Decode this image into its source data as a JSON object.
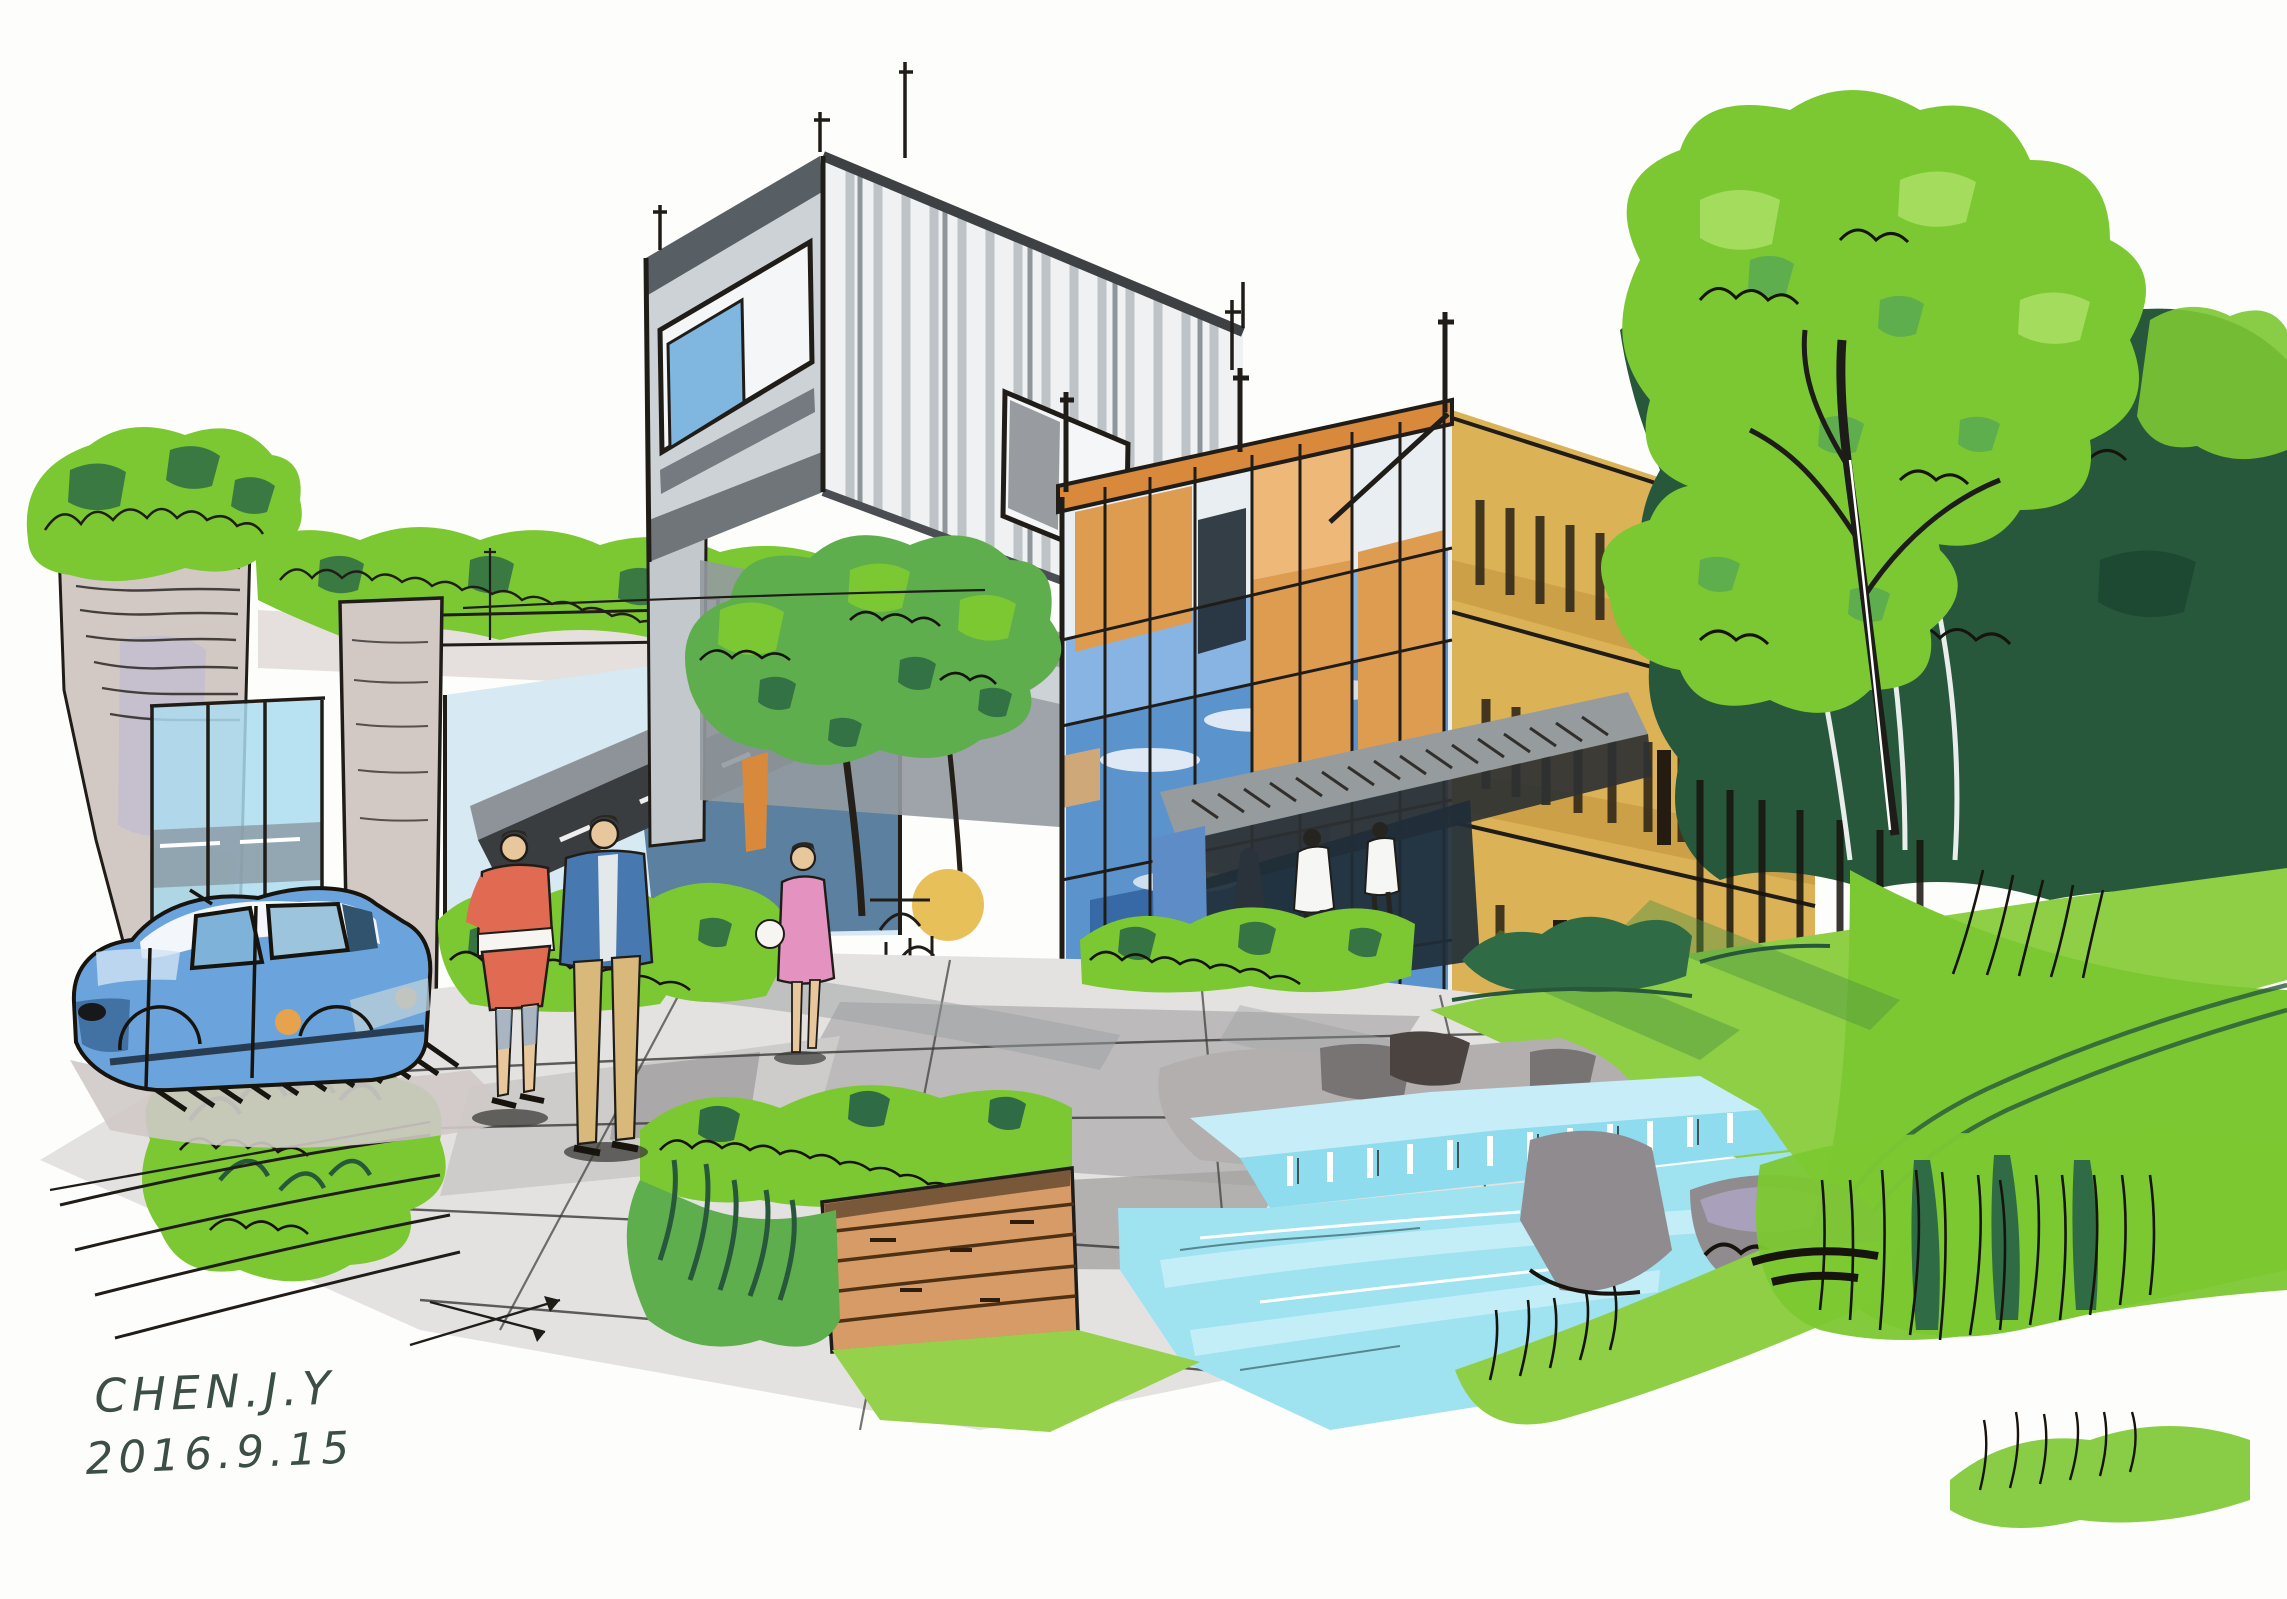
{
  "artwork": {
    "kind": "hand-drawn architectural marker sketch",
    "signature": {
      "line1": "CHEN.J.Y",
      "line2": "2016.9.15"
    }
  },
  "palette": {
    "paper": "#fdfdfb",
    "ink": "#201d19",
    "signature": "#3b4f44",
    "green-bright": "#7cc832",
    "green-light": "#a9de63",
    "green-mid": "#5fae4e",
    "green-dark": "#2f6b45",
    "green-deep": "#27583c",
    "lawn": "#8fcf45",
    "lawn-dark": "#4f9340",
    "taupe": "#d2c9c5",
    "taupe-dark": "#b7adaa",
    "lavender": "#b9b4d6",
    "box-light": "#cdd2d6",
    "box-face": "#eff1f2",
    "box-dark": "#585f64",
    "corrugation": "#b9bfc4",
    "corrugation-dark": "#8e959b",
    "support-gray": "#c3c8cc",
    "mass-gray": "#949aa0",
    "glass-pale": "#d7e9f2",
    "glass-fence": "#abdcee",
    "fence-band": "#8a98a4",
    "slab-light": "#8d9399",
    "slab-dark": "#3a3d40",
    "under-glass": "#456d92",
    "window-blue": "#7fb7e0",
    "curtain-blue": "#5b93cc",
    "curtain-light": "#8cb8e4",
    "curtain-deep": "#2e5f9e",
    "panel-dark": "#1f2a33",
    "orange": "#de9c50",
    "orange-light": "#eeb978",
    "orange-deep": "#d8893c",
    "tan": "#dcb257",
    "tan-band": "#c59a40",
    "slit": "#33291a",
    "awning": "#969b9e",
    "awning-shadow": "#2e3133",
    "entrance": "#1f2e38",
    "entrance-blue": "#5e8cc6",
    "pave": "#e4e2e1",
    "pave-mid": "#cecccb",
    "pave-dark": "#b5b3b3",
    "pave-deep": "#a6a4a4",
    "shadow-gray": "#9aa0a2",
    "stone": "#b3afae",
    "stone-dark": "#6e6a6a",
    "rock": "#8f8b8e",
    "rock-lavender": "#b3aace",
    "pool-pale": "#c6edf8",
    "pool-mid": "#8edcee",
    "pool-water": "#9fe2f0",
    "pool-streak": "#c9f0f9",
    "wood": "#d69b66",
    "wood-line": "#4e3015",
    "car-blue": "#6ba3dc",
    "car-deep": "#3b6a9a",
    "car-glass": "#7fb2d8",
    "car-glass2": "#9cc4dc",
    "amber": "#e6a24c",
    "skin": "#e9c79c",
    "shirt-red": "#e06a52",
    "jacket-blue": "#4878b0",
    "khaki": "#d9b87c",
    "pink": "#e493c0",
    "denim": "#7fa8d8",
    "soft-shadow": "#cfc9c6",
    "dark-blob": "#3b3b38"
  }
}
